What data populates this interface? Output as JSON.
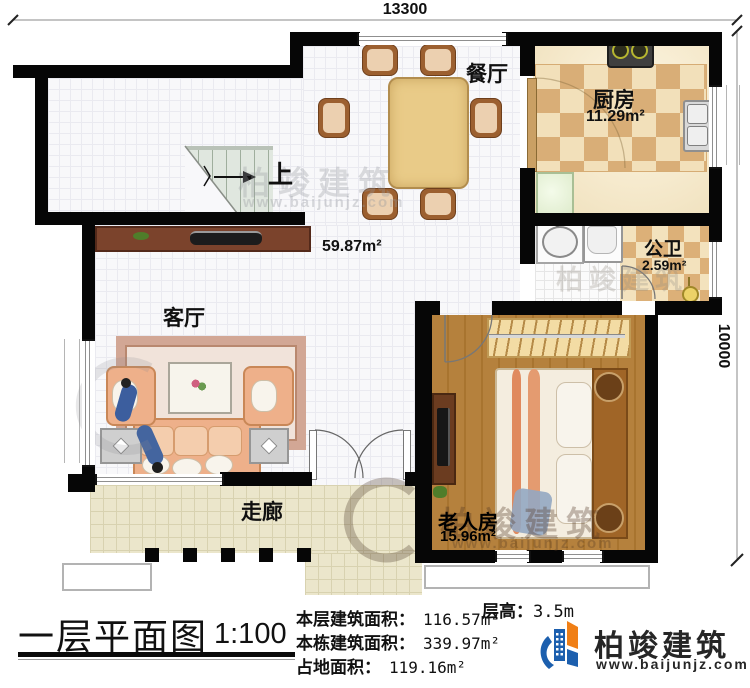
{
  "dimensions": {
    "top": "13300",
    "right": "10000"
  },
  "rooms": {
    "dining": {
      "label": "餐厅"
    },
    "kitchen": {
      "label": "厨房",
      "area": "11.29m²"
    },
    "bath": {
      "label": "公卫",
      "area": "2.59m²"
    },
    "living": {
      "label": "客厅"
    },
    "bedroom": {
      "label": "老人房",
      "area": "15.96m²"
    },
    "corridor": {
      "label": "走廊"
    },
    "hall": {
      "area": "59.87m²"
    },
    "stairs": {
      "label": "上"
    }
  },
  "watermark": {
    "name": "柏竣建筑",
    "url": "www.baijunjz.com"
  },
  "footer": {
    "title": "一层平面图",
    "scale": "1:100",
    "floor_height_label": "层高：",
    "floor_height_value": "3.5m",
    "stats": [
      {
        "label": "本层建筑面积：",
        "value": "116.57m²"
      },
      {
        "label": "本栋建筑面积：",
        "value": "339.97m²"
      },
      {
        "label": "占地面积：",
        "value": "119.16m²"
      }
    ],
    "brand": {
      "name": "柏竣建筑",
      "url": "www.baijunjz.com"
    }
  },
  "colors": {
    "wall": "#060606",
    "checker_dark": "#d9ae77",
    "checker_light": "#f2e0ba",
    "wood": "#b5813d",
    "brand_blue": "#1c5fae",
    "brand_orange": "#f07f16"
  }
}
